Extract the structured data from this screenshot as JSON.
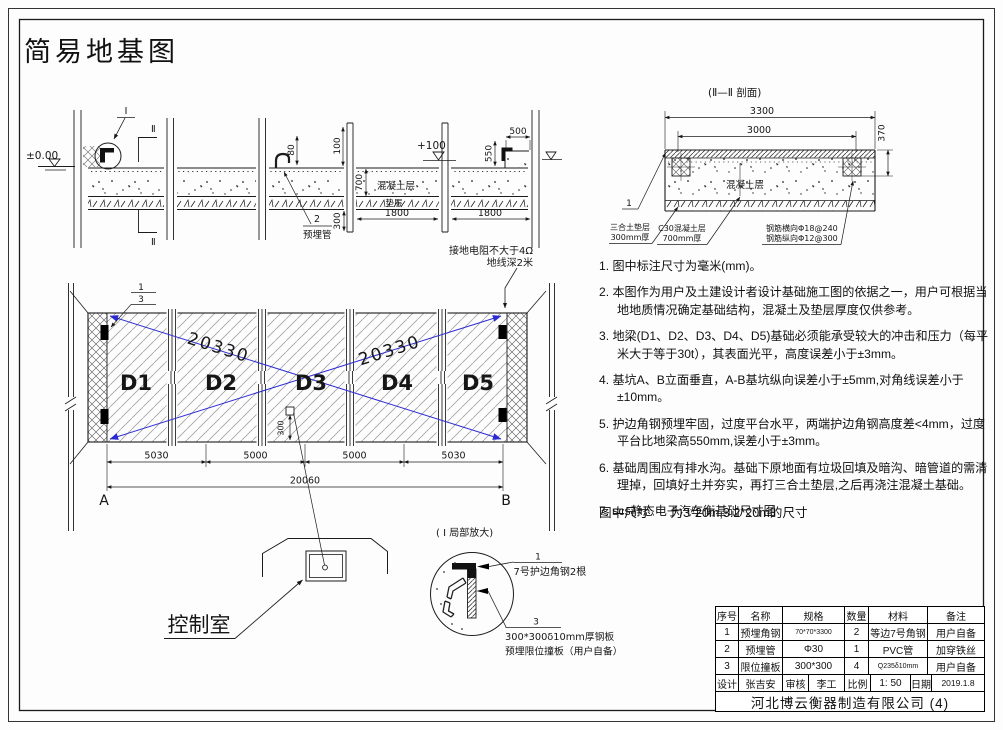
{
  "frame": {
    "title": "简易地基图"
  },
  "elevation": {
    "level_zero": "±0.00",
    "detail_mark": "Ⅰ",
    "section_mark": "Ⅱ",
    "level_100": "+100",
    "dim_80": "80",
    "dim_100": "100",
    "dim_700": "700",
    "dim_pipe_300": "300",
    "dim_1800_a": "1800",
    "dim_1800_b": "1800",
    "dim_550": "550",
    "dim_500": "500",
    "concrete_label": "混凝土层",
    "cushion_label": "垫层",
    "pipe_callout_num": "2",
    "pipe_callout_label": "预埋管",
    "grounding_line1": "接地电阻不大于4Ω",
    "grounding_line2": "地线深2米"
  },
  "section": {
    "title": "(Ⅱ—Ⅱ 剖面)",
    "dim_3300": "3300",
    "dim_3000": "3000",
    "dim_370": "370",
    "concrete_label": "混凝土层",
    "leader_num": "1",
    "cushion_label_1": "三合土垫层",
    "cushion_label_2": "300mm厚",
    "c30_label_1": "C30混凝土层",
    "c30_label_2": "700mm厚",
    "rebar_label_1": "钢筋横向Φ18@240",
    "rebar_label_2": "钢筋纵向Φ12@300"
  },
  "plan": {
    "modules": [
      "D1",
      "D2",
      "D3",
      "D4",
      "D5"
    ],
    "diagonal_dim": "20330",
    "dim_5030_a": "5030",
    "dim_5000_a": "5000",
    "dim_5000_b": "5000",
    "dim_5030_b": "5030",
    "dim_total": "20060",
    "dim_300": "300",
    "corner_a": "A",
    "corner_b": "B",
    "callout_1": "1",
    "callout_3": "3"
  },
  "control_room": {
    "label": "控制室"
  },
  "detail": {
    "title": "( Ⅰ 局部放大)",
    "num_1": "1",
    "label_1": "7号护边角钢2根",
    "num_3": "3",
    "label_3a": "300*300δ10mm厚钢板",
    "label_3b": "预埋限位撞板（用户自备）"
  },
  "notes": [
    {
      "text": "1. 图中标注尺寸为毫米(mm)。"
    },
    {
      "text": "2. 本图作为用户及土建设计者设计基础施工图的依据之一，用户可根据当地地质情况确定基础结构，混凝土及垫层厚度仅供参考。"
    },
    {
      "text": "3. 地梁(D1、D2、D3、D4、D5)基础必须能承受较大的冲击和压力（每平米大于等于30t），其表面光平，高度误差小于±3mm。"
    },
    {
      "text": "4. 基坑A、B立面垂直，A-B基坑纵向误差小于±5mm,对角线误差小于±10mm。"
    },
    {
      "text": "5. 护边角钢预埋牢固，过度平台水平，两端护边角钢高度差<4mm，过度平台比地梁高550mm,误差小于±3mm。"
    },
    {
      "text": "6. 基础周围应有排水沟。基础下原地面有垃圾回填及暗沟、暗管道的需清理掉，回填好土并夯实，再打三合土垫层,之后再浇注混凝土基础。"
    },
    {
      "text": "7. scs静态电子汽车衡基础尺寸图"
    }
  ],
  "size_note": "图中尺寸      为3*20m,3.2*20m的尺寸",
  "title_block": {
    "headers": [
      "序号",
      "名称",
      "规格",
      "数量",
      "材料",
      "备注"
    ],
    "rows": [
      {
        "no": "1",
        "name": "预埋角钢",
        "spec": "70*70*3300",
        "qty": "2",
        "material": "等边7号角钢",
        "note": "用户自备"
      },
      {
        "no": "2",
        "name": "预埋管",
        "spec": "Φ30",
        "qty": "1",
        "material": "PVC管",
        "note": "加穿铁丝"
      },
      {
        "no": "3",
        "name": "限位撞板",
        "spec": "300*300",
        "qty": "4",
        "material": "Q235δ10mm",
        "note": "用户自备"
      }
    ],
    "design_label": "设计",
    "designer": "张吉安",
    "audit_label": "审核",
    "auditor": "李工",
    "scale_label": "比例",
    "scale_value": "1: 50",
    "date_label": "日期",
    "date_value": "2019.1.8",
    "company": "河北博云衡器制造有限公司 (4)"
  }
}
